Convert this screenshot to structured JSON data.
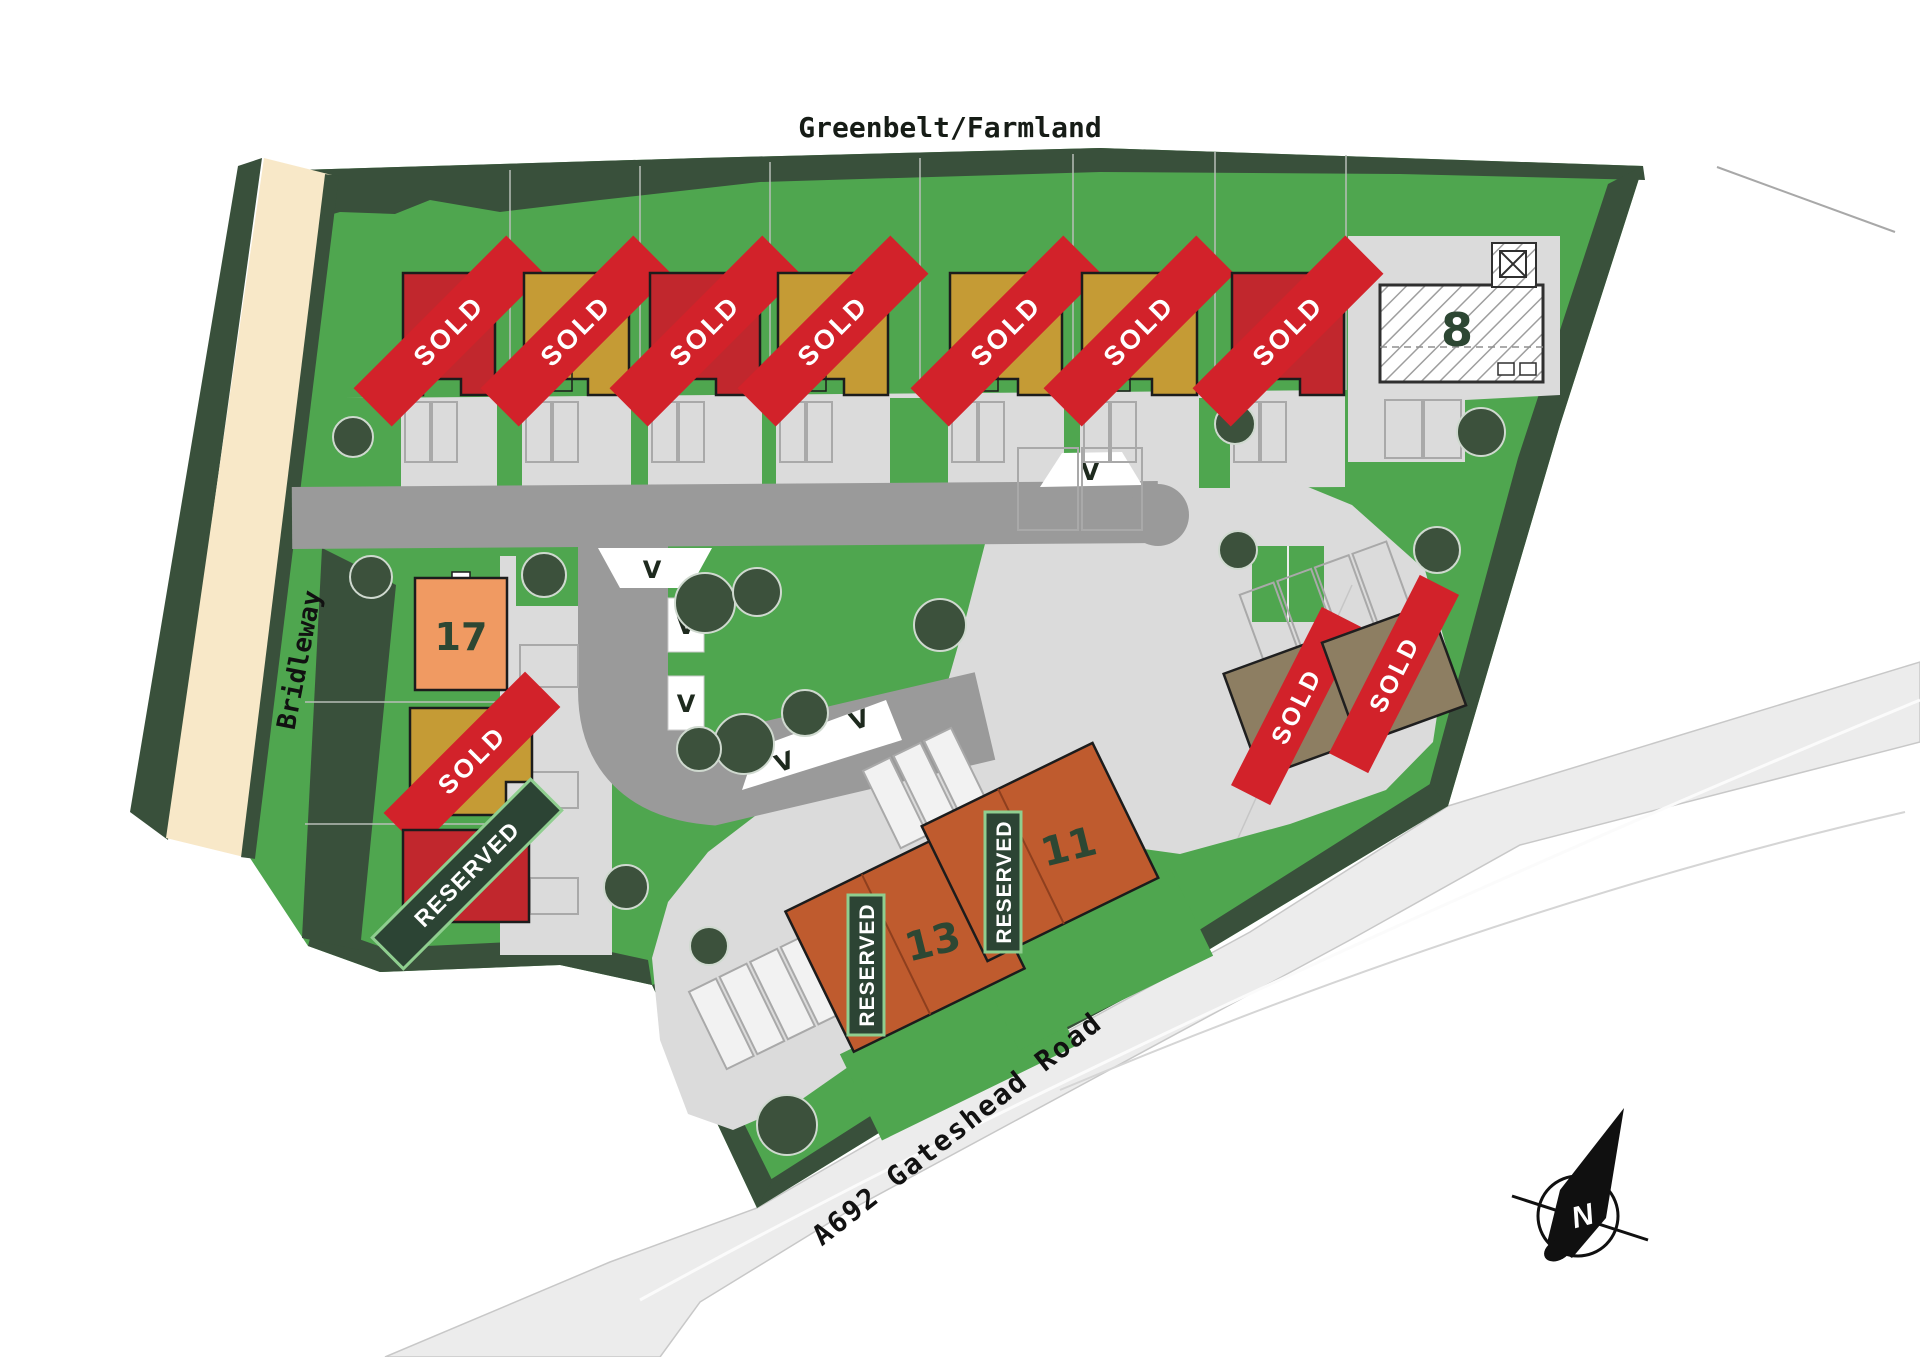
{
  "title": "Greenbelt/Farmland",
  "road_labels": {
    "bridleway": "Bridleway",
    "a692": "A692 Gateshead Road"
  },
  "status_labels": {
    "sold": "SOLD",
    "reserved": "RESERVED"
  },
  "visitor_bay_marker": "V",
  "compass_north": "N",
  "plot_numbers": {
    "p8": "8",
    "p11": "11",
    "p13": "13",
    "p17": "17"
  },
  "colors": {
    "grass": "#4FA64F",
    "hedge": "#39503B",
    "road": "#9A9A9A",
    "paving": "#DBDBDB",
    "bridleway": "#F8E8C8",
    "sold_banner": "#D2222A",
    "reserved_banner": "#2C4434",
    "reserved_border": "#8FCE8F",
    "house_red": "#C1272D",
    "house_gold": "#C59B35",
    "house_orange": "#F09A62",
    "house_terracotta": "#BF5B2E",
    "house_olive": "#8D7E62"
  }
}
